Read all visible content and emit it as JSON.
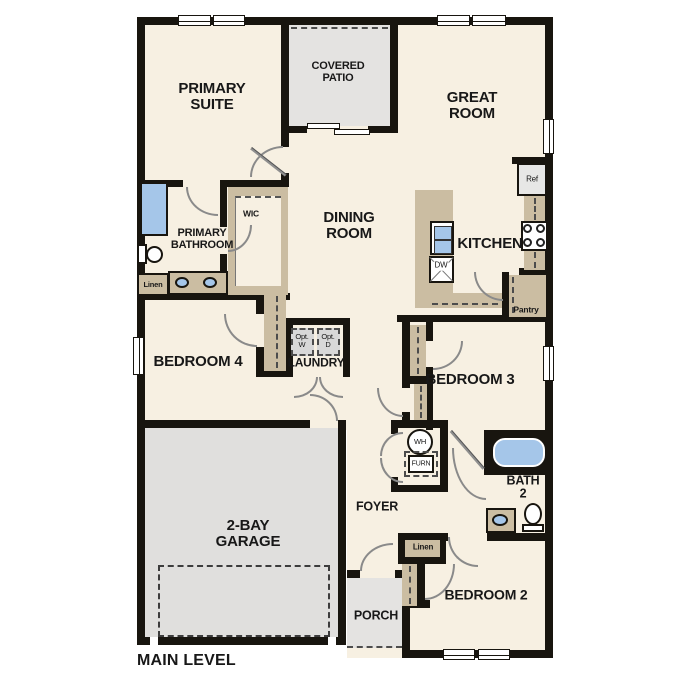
{
  "title": "MAIN LEVEL",
  "colors": {
    "wall": "#18150f",
    "room": "#f7f0e2",
    "patio": "#e4e3e1",
    "garage": "#e0dfdd",
    "cabinet": "#cbbda2",
    "blue": "#a5c6e9",
    "appliance": "#e7e7e6",
    "optgray": "#d8d8d8",
    "arc": "#8a8a8a"
  },
  "rooms": {
    "primary_suite": "PRIMARY\nSUITE",
    "covered_patio": "COVERED\nPATIO",
    "great_room": "GREAT\nROOM",
    "dining_room": "DINING\nROOM",
    "kitchen": "KITCHEN",
    "primary_bathroom": "PRIMARY\nBATHROOM",
    "wic": "WIC",
    "linen": "Linen",
    "bedroom4": "BEDROOM 4",
    "laundry": "LAUNDRY",
    "pantry": "Pantry",
    "bedroom3": "BEDROOM 3",
    "bath2": "BATH\n2",
    "foyer": "FOYER",
    "bedroom2": "BEDROOM 2",
    "garage": "2-BAY\nGARAGE",
    "porch": "PORCH"
  },
  "fixtures": {
    "ref": "Ref",
    "dw": "DW",
    "opt_w": "Opt.\nW",
    "opt_d": "Opt.\nD",
    "wh": "WH",
    "furn": "FURN"
  }
}
